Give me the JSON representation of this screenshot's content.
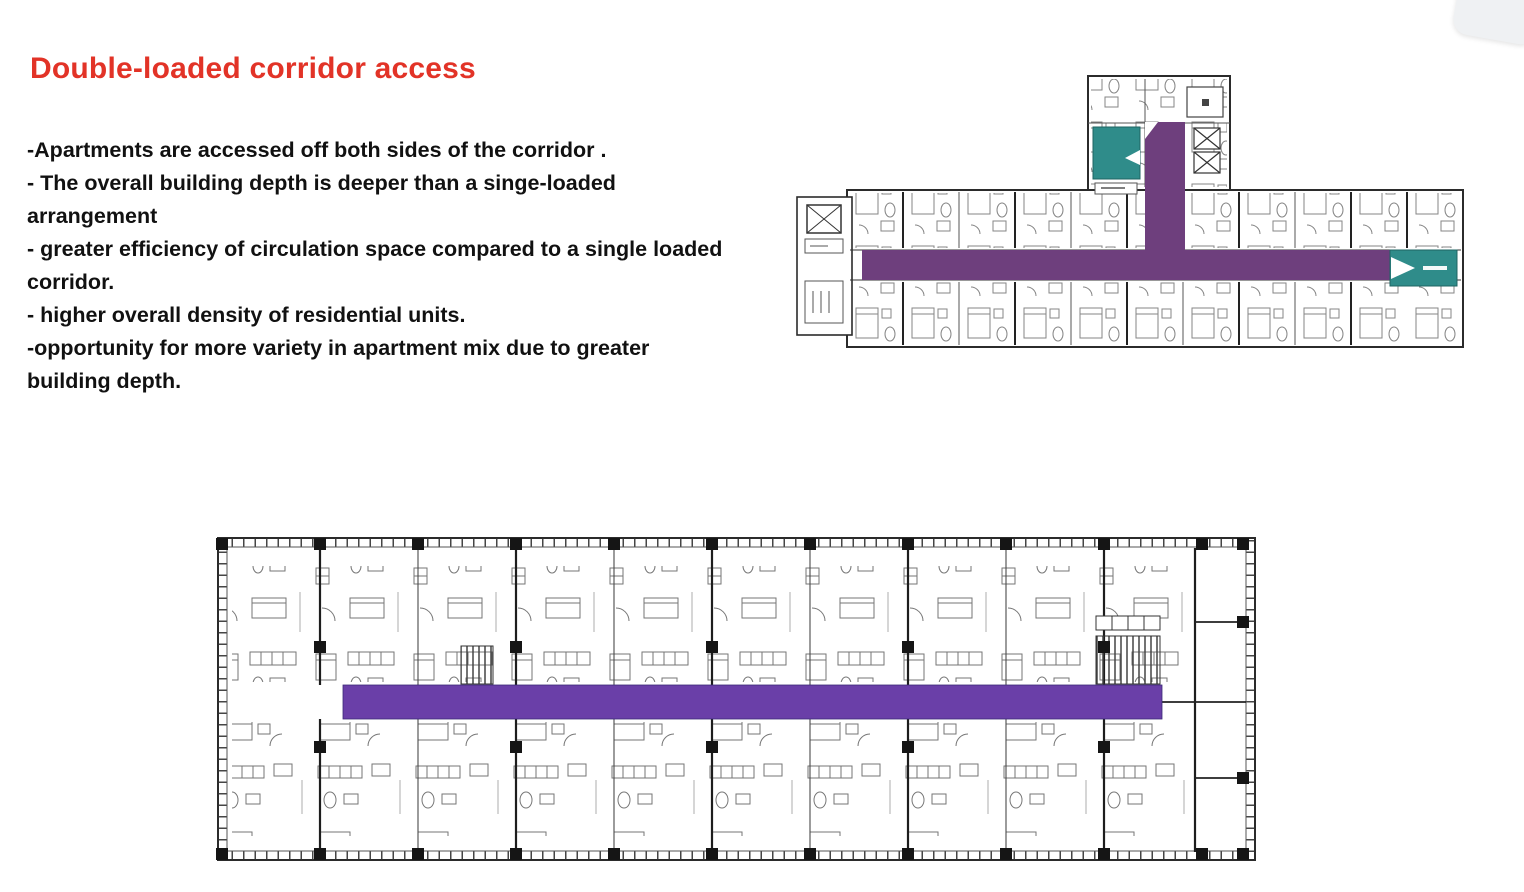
{
  "slide": {
    "title": "Double-loaded corridor access",
    "bullets": [
      "-Apartments are accessed off both sides of the corridor .",
      "- The overall building depth is deeper than a singe-loaded arrangement",
      "- greater efficiency of circulation space compared to a single loaded corridor.",
      "- higher overall density of residential units.",
      "-opportunity for more variety in apartment mix due to greater building depth."
    ]
  },
  "plans": {
    "top": {
      "description": "T-shaped hotel-style floor plan with double-loaded corridor highlighted",
      "corridor_highlight": "purple",
      "core_highlights": 2
    },
    "bottom": {
      "description": "Long linear apartment floor plan with central double-loaded corridor highlighted",
      "corridor_highlight": "purple"
    }
  },
  "colors": {
    "background": "#ffffff",
    "title_red": "#e23327",
    "body_text": "#111111",
    "purple_top": "#6e3f7d",
    "purple_bottom": "#6a3fa8",
    "teal": "#2f8c8a",
    "plan_line": "#2b2b2b",
    "widget_bg": "#eff1f3",
    "widget_glyph": "#4b5b6b"
  }
}
